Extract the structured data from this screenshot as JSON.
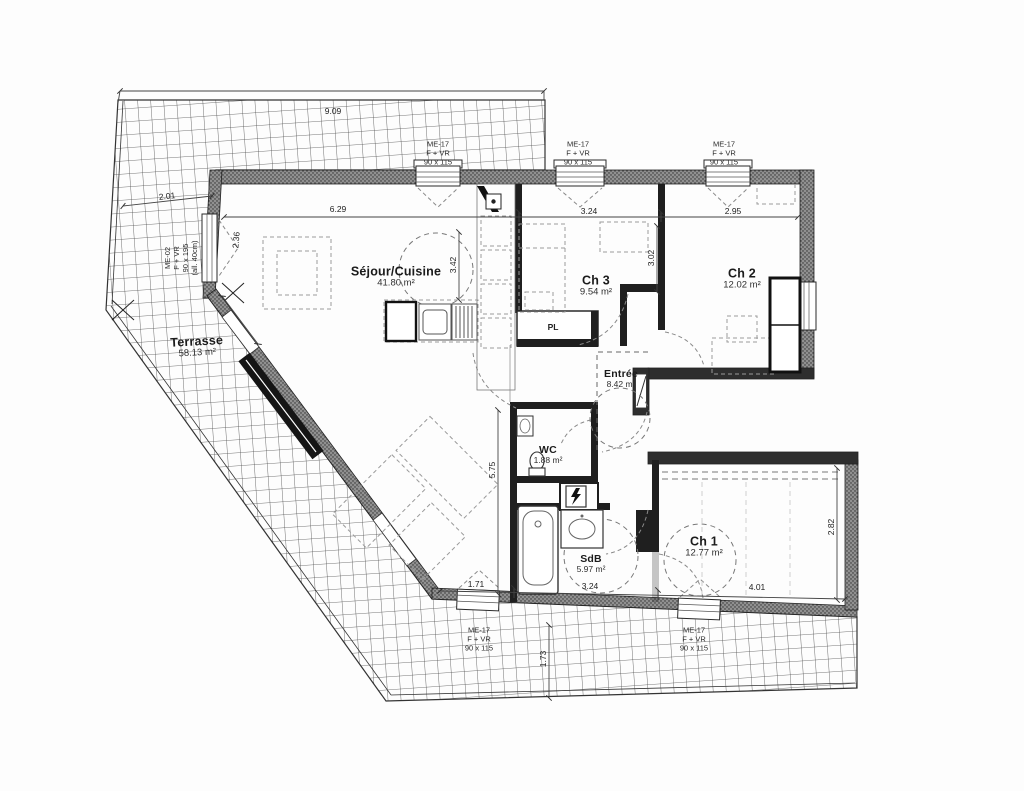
{
  "plan": {
    "rooms": [
      {
        "name": "Terrasse",
        "area": "58.13 m²"
      },
      {
        "name": "Séjour/Cuisine",
        "area": "41.80 m²"
      },
      {
        "name": "Ch 3",
        "area": "9.54 m²"
      },
      {
        "name": "Ch 2",
        "area": "12.02 m²"
      },
      {
        "name": "Entrée",
        "area": "8.42 m²"
      },
      {
        "name": "WC",
        "area": "1.88 m²"
      },
      {
        "name": "SdB",
        "area": "5.97 m²"
      },
      {
        "name": "Ch 1",
        "area": "12.77 m²"
      }
    ],
    "closet_label": "PL",
    "joinery": {
      "me17": {
        "ref": "ME-17",
        "type": "F + VR",
        "size": "90 x 115"
      },
      "me02": {
        "ref": "ME-02",
        "type": "F + VR",
        "size": "90 x 195",
        "note": "(all. 40cm)"
      }
    },
    "dimensions": {
      "top_overall": "9.09",
      "sejour_width": "6.29",
      "ch3_width": "3.24",
      "ch2_width": "2.95",
      "terrace_left": "2.01",
      "left_wall": "2.36",
      "sejour_depth": "3.42",
      "ch3_depth": "3.02",
      "wet_depth": "5.75",
      "bottom_left": "1.71",
      "sdb_width": "3.24",
      "ch1_width": "4.01",
      "ch1_depth": "2.82",
      "terrace_bottom": "1.73"
    },
    "colors": {
      "wall_dark": "#2e2e2e",
      "wall_hatch": "#909090",
      "grid_line": "#4d4d4d",
      "dash": "#8a8a8a"
    }
  }
}
